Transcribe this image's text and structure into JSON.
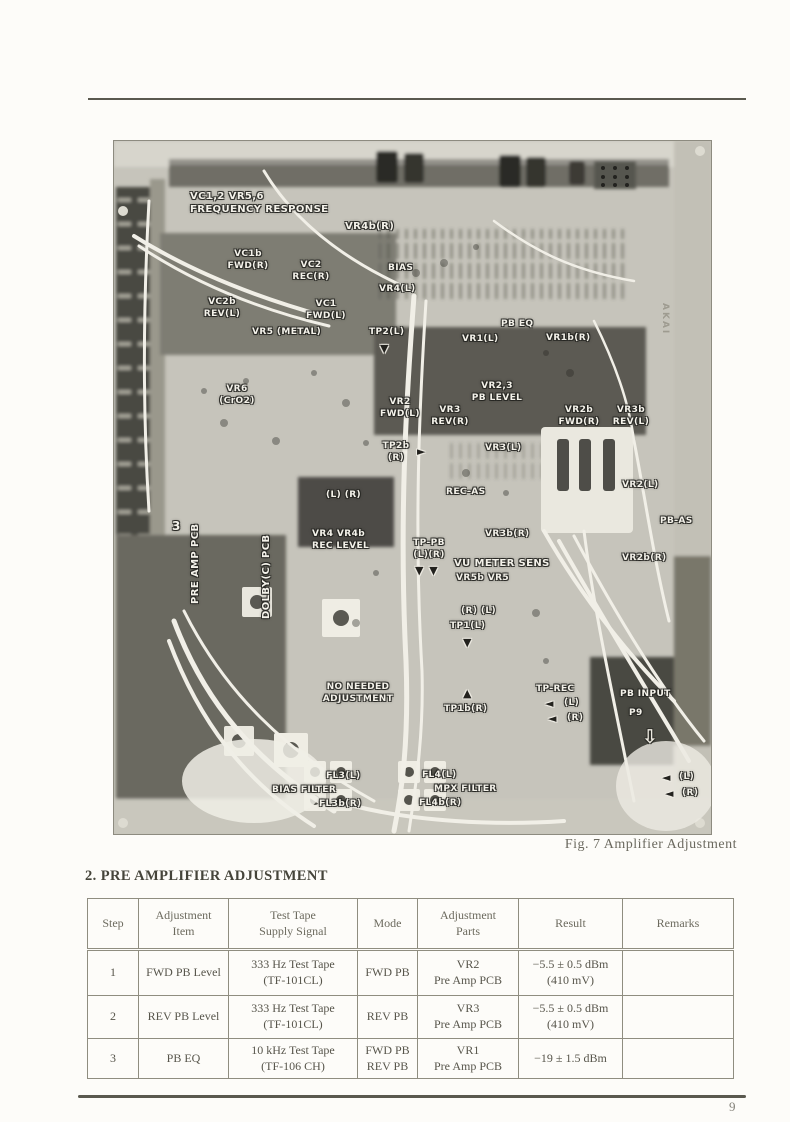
{
  "page": {
    "number": "9"
  },
  "section": {
    "heading": "2. PRE AMPLIFIER ADJUSTMENT"
  },
  "figure": {
    "caption": "Fig. 7  Amplifier Adjustment"
  },
  "colors": {
    "page_bg": "#fdfcf9",
    "photo_base": "#c6c4bb",
    "rule": "#5a594f",
    "table_border": "#8f8d80",
    "label_text": "#f4f2ea"
  },
  "photo": {
    "annotations": [
      {
        "name": "freq-response-label",
        "text": "VC1,2  VR5,6\nFREQUENCY RESPONSE",
        "x": 76,
        "y": 49,
        "size": 10
      },
      {
        "name": "vr4b-r-label",
        "text": "VR4b(R)",
        "x": 231,
        "y": 79,
        "size": 10
      },
      {
        "name": "vc1b-fwd-r-label",
        "text": "VC1b\nFWD(R)",
        "x": 112,
        "y": 108,
        "cls": "center",
        "w": 44
      },
      {
        "name": "vc2-rec-r-label",
        "text": "VC2\nREC(R)",
        "x": 175,
        "y": 119,
        "cls": "center",
        "w": 44
      },
      {
        "name": "vc2b-rev-l-label",
        "text": "VC2b\nREV(L)",
        "x": 86,
        "y": 156,
        "cls": "center",
        "w": 44
      },
      {
        "name": "vc1-fwd-l-label",
        "text": "VC1\nFWD(L)",
        "x": 190,
        "y": 158,
        "cls": "center",
        "w": 44
      },
      {
        "name": "vr5-metal-label",
        "text": "VR5 (METAL)",
        "x": 138,
        "y": 186
      },
      {
        "name": "vr6-cro2-label",
        "text": "VR6\n(CrO2)",
        "x": 103,
        "y": 243,
        "cls": "center",
        "w": 40
      },
      {
        "name": "bias-label",
        "text": "BIAS",
        "x": 274,
        "y": 122
      },
      {
        "name": "vr4-l-label",
        "text": "VR4(L)",
        "x": 265,
        "y": 143
      },
      {
        "name": "tp2-l-label",
        "text": "TP2(L)",
        "x": 255,
        "y": 186
      },
      {
        "name": "tp2-l-arrow-icon",
        "text": "▼",
        "x": 266,
        "y": 201,
        "cls": "dark-arrow"
      },
      {
        "name": "pb-eq-label",
        "text": "PB EQ",
        "x": 387,
        "y": 178
      },
      {
        "name": "vr1-l-label",
        "text": "VR1(L)",
        "x": 348,
        "y": 193
      },
      {
        "name": "vr1b-r-label",
        "text": "VR1b(R)",
        "x": 432,
        "y": 192
      },
      {
        "name": "vr23-pb-level-label",
        "text": "VR2,3\nPB LEVEL",
        "x": 357,
        "y": 240,
        "cls": "center",
        "w": 52
      },
      {
        "name": "vr2-fwd-l-label",
        "text": "VR2\nFWD(L)",
        "x": 264,
        "y": 256,
        "cls": "center",
        "w": 44
      },
      {
        "name": "vr3-rev-r-label",
        "text": "VR3\nREV(R)",
        "x": 314,
        "y": 264,
        "cls": "center",
        "w": 44
      },
      {
        "name": "vr2b-fwd-r-label",
        "text": "VR2b\nFWD(R)",
        "x": 442,
        "y": 264,
        "cls": "center",
        "w": 46
      },
      {
        "name": "vr3b-rev-l-label",
        "text": "VR3b\nREV(L)",
        "x": 495,
        "y": 264,
        "cls": "center",
        "w": 44
      },
      {
        "name": "tp2b-r-label",
        "text": "TP2b\n(R)",
        "x": 264,
        "y": 300,
        "cls": "center",
        "w": 36
      },
      {
        "name": "tp2b-r-arrow-icon",
        "text": "►",
        "x": 303,
        "y": 304,
        "cls": "dark-arrow"
      },
      {
        "name": "vr3-l-label",
        "text": "VR3(L)",
        "x": 371,
        "y": 302
      },
      {
        "name": "rec-as-label",
        "text": "REC-AS",
        "x": 332,
        "y": 346
      },
      {
        "name": "vr3b-r-label",
        "text": "VR3b(R)",
        "x": 371,
        "y": 388
      },
      {
        "name": "l-r-pair-label",
        "text": "(L)   (R)",
        "x": 212,
        "y": 349
      },
      {
        "name": "vr4-vr4b-rec-level-label",
        "text": "VR4  VR4b\nREC LEVEL",
        "x": 198,
        "y": 388
      },
      {
        "name": "tp-pb-label",
        "text": "TP-PB\n(L)(R)",
        "x": 295,
        "y": 397,
        "cls": "center",
        "w": 40
      },
      {
        "name": "tp-pb-arrows-icon",
        "text": "▼ ▼",
        "x": 301,
        "y": 423,
        "cls": "dark-arrow"
      },
      {
        "name": "vu-meter-sens-label",
        "text": "VU METER SENS",
        "x": 340,
        "y": 416,
        "size": 10
      },
      {
        "name": "vr5b-vr5-label",
        "text": "VR5b    VR5",
        "x": 342,
        "y": 432
      },
      {
        "name": "r-l-pair-label",
        "text": "(R)      (L)",
        "x": 347,
        "y": 465
      },
      {
        "name": "tp1-l-label",
        "text": "TP1(L)",
        "x": 336,
        "y": 480
      },
      {
        "name": "tp1-l-arrow-icon",
        "text": "▼",
        "x": 349,
        "y": 495,
        "cls": "dark-arrow"
      },
      {
        "name": "tp1b-r-arrow-icon",
        "text": "▲",
        "x": 349,
        "y": 546,
        "cls": "dark-arrow"
      },
      {
        "name": "tp1b-r-label",
        "text": "TP1b(R)",
        "x": 330,
        "y": 563
      },
      {
        "name": "no-needed-adjustment-label",
        "text": "NO NEEDED\nADJUSTMENT",
        "x": 208,
        "y": 541,
        "cls": "center",
        "w": 72
      },
      {
        "name": "tp-rec-label",
        "text": "TP-REC",
        "x": 422,
        "y": 543
      },
      {
        "name": "tp-rec-l-arrow-icon",
        "text": "◄",
        "x": 431,
        "y": 556,
        "cls": "dark-arrow"
      },
      {
        "name": "tp-rec-l-label",
        "text": "(L)",
        "x": 450,
        "y": 557
      },
      {
        "name": "tp-rec-r-arrow-icon",
        "text": "◄",
        "x": 434,
        "y": 571,
        "cls": "dark-arrow"
      },
      {
        "name": "tp-rec-r-label",
        "text": "(R)",
        "x": 453,
        "y": 572
      },
      {
        "name": "fl3-l-label",
        "text": "FL3(L)",
        "x": 212,
        "y": 630
      },
      {
        "name": "bias-filter-label",
        "text": "BIAS FILTER",
        "x": 158,
        "y": 644
      },
      {
        "name": "fl3b-r-label",
        "text": "FL3b(R)",
        "x": 205,
        "y": 658
      },
      {
        "name": "fl4-l-label",
        "text": "FL4(L)",
        "x": 308,
        "y": 629
      },
      {
        "name": "mpx-filter-label",
        "text": "MPX FILTER",
        "x": 320,
        "y": 643
      },
      {
        "name": "fl4b-r-label",
        "text": "FL4b(R)",
        "x": 305,
        "y": 657
      },
      {
        "name": "pb-input-label",
        "text": "PB INPUT",
        "x": 506,
        "y": 548
      },
      {
        "name": "p9-label",
        "text": "P9",
        "x": 515,
        "y": 567
      },
      {
        "name": "p9-arrow-icon",
        "text": "⇩",
        "x": 528,
        "y": 584,
        "cls": "hollow-arrow"
      },
      {
        "name": "pb-out-l-arrow-icon",
        "text": "◄",
        "x": 548,
        "y": 630,
        "cls": "dark-arrow"
      },
      {
        "name": "pb-out-l-label",
        "text": "(L)",
        "x": 565,
        "y": 631
      },
      {
        "name": "pb-out-r-arrow-icon",
        "text": "◄",
        "x": 551,
        "y": 646,
        "cls": "dark-arrow"
      },
      {
        "name": "pb-out-r-label",
        "text": "(R)",
        "x": 568,
        "y": 647
      },
      {
        "name": "vr2-l-label",
        "text": "VR2(L)",
        "x": 508,
        "y": 339
      },
      {
        "name": "pb-as-label",
        "text": "PB-AS",
        "x": 546,
        "y": 375
      },
      {
        "name": "vr2b-r-label",
        "text": "VR2b(R)",
        "x": 508,
        "y": 412
      },
      {
        "name": "connector-3-label",
        "text": "3",
        "x": 58,
        "y": 378,
        "size": 12
      },
      {
        "name": "pre-amp-pcb-label",
        "text": "PRE AMP PCB",
        "x": 75,
        "y": 463,
        "cls": "vert",
        "rotate": -90,
        "size": 10
      },
      {
        "name": "dolby-pcb-label",
        "text": "DOLBY(C) PCB",
        "x": 146,
        "y": 478,
        "cls": "vert",
        "rotate": -90,
        "size": 10
      },
      {
        "name": "akai-mark-label",
        "text": "AKAI",
        "x": 556,
        "y": 162,
        "cls": "vert faint",
        "rotate": 90,
        "size": 9
      }
    ]
  },
  "table": {
    "headers": [
      "Step",
      "Adjustment\nItem",
      "Test Tape\nSupply Signal",
      "Mode",
      "Adjustment\nParts",
      "Result",
      "Remarks"
    ],
    "rows": [
      [
        "1",
        "FWD PB Level",
        "333 Hz Test Tape\n(TF-101CL)",
        "FWD PB",
        "VR2\nPre Amp PCB",
        "−5.5 ± 0.5 dBm\n(410 mV)",
        ""
      ],
      [
        "2",
        "REV PB Level",
        "333 Hz Test Tape\n(TF-101CL)",
        "REV PB",
        "VR3\nPre Amp PCB",
        "−5.5 ± 0.5 dBm\n(410 mV)",
        ""
      ],
      [
        "3",
        "PB EQ",
        "10 kHz Test Tape\n(TF-106 CH)",
        "FWD PB\nREV PB",
        "VR1\nPre Amp PCB",
        "−19 ± 1.5 dBm",
        ""
      ]
    ]
  }
}
